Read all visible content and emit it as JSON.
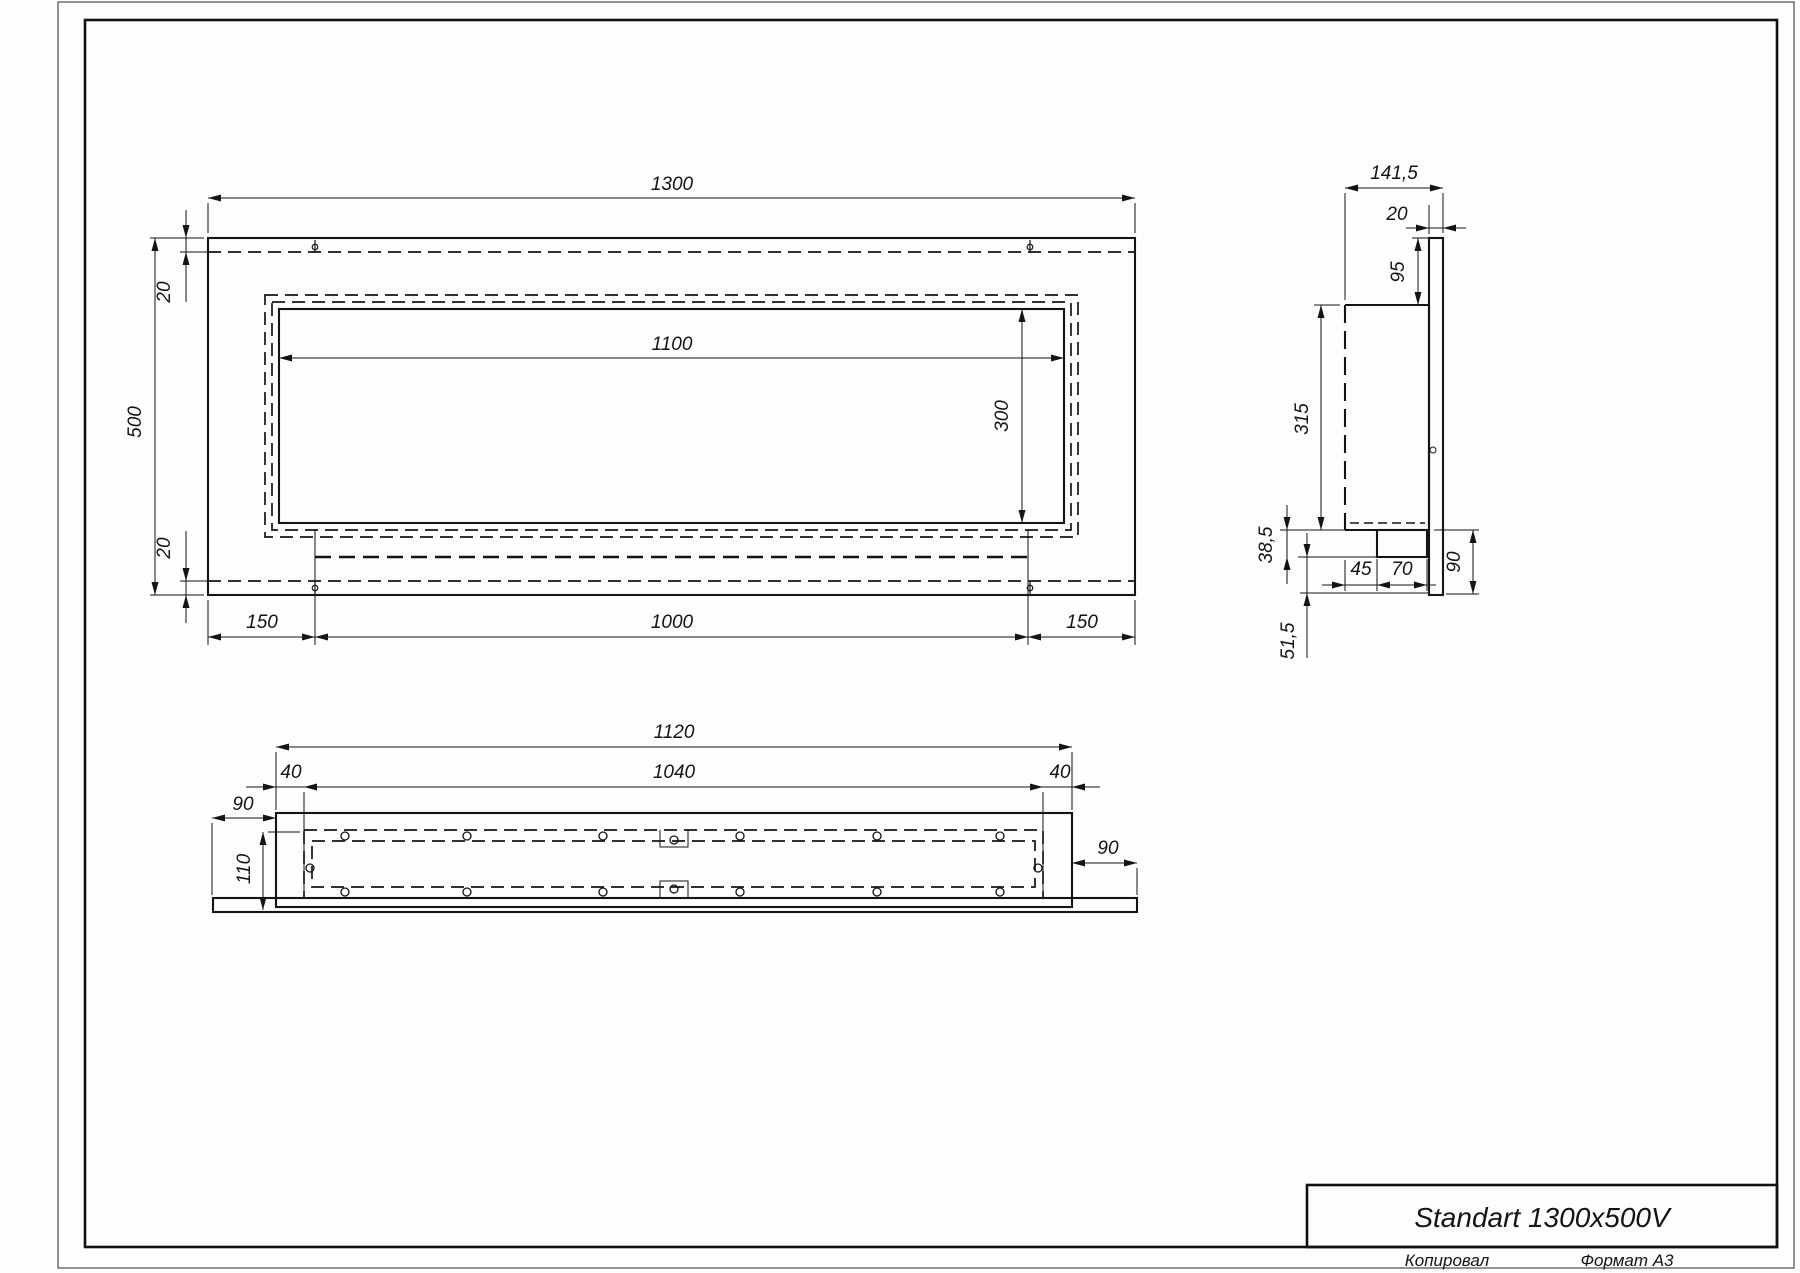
{
  "title_block": {
    "product_name": "Standart 1300x500V",
    "copied_label": "Копировал",
    "format_label": "Формат А3"
  },
  "views": {
    "front": {
      "dims": {
        "overall_width": "1300",
        "overall_height": "500",
        "top_inset": "20",
        "bottom_inset": "20",
        "opening_width": "1100",
        "opening_height": "300",
        "left_margin": "150",
        "slot_span": "1000",
        "right_margin": "150"
      }
    },
    "side": {
      "dims": {
        "overall_depth": "141,5",
        "panel_thickness": "20",
        "panel_top_overhang": "95",
        "body_height": "315",
        "foot_drop": "38,5",
        "panel_bottom_run": "51,5",
        "foot_offset": "45",
        "foot_depth": "70",
        "panel_bottom_overhang": "90"
      }
    },
    "bottom": {
      "dims": {
        "body_width": "1120",
        "inner_width": "1040",
        "left_inset": "40",
        "right_inset": "40",
        "panel_overhang_left": "90",
        "panel_overhang_right": "90",
        "body_depth": "110"
      }
    }
  }
}
